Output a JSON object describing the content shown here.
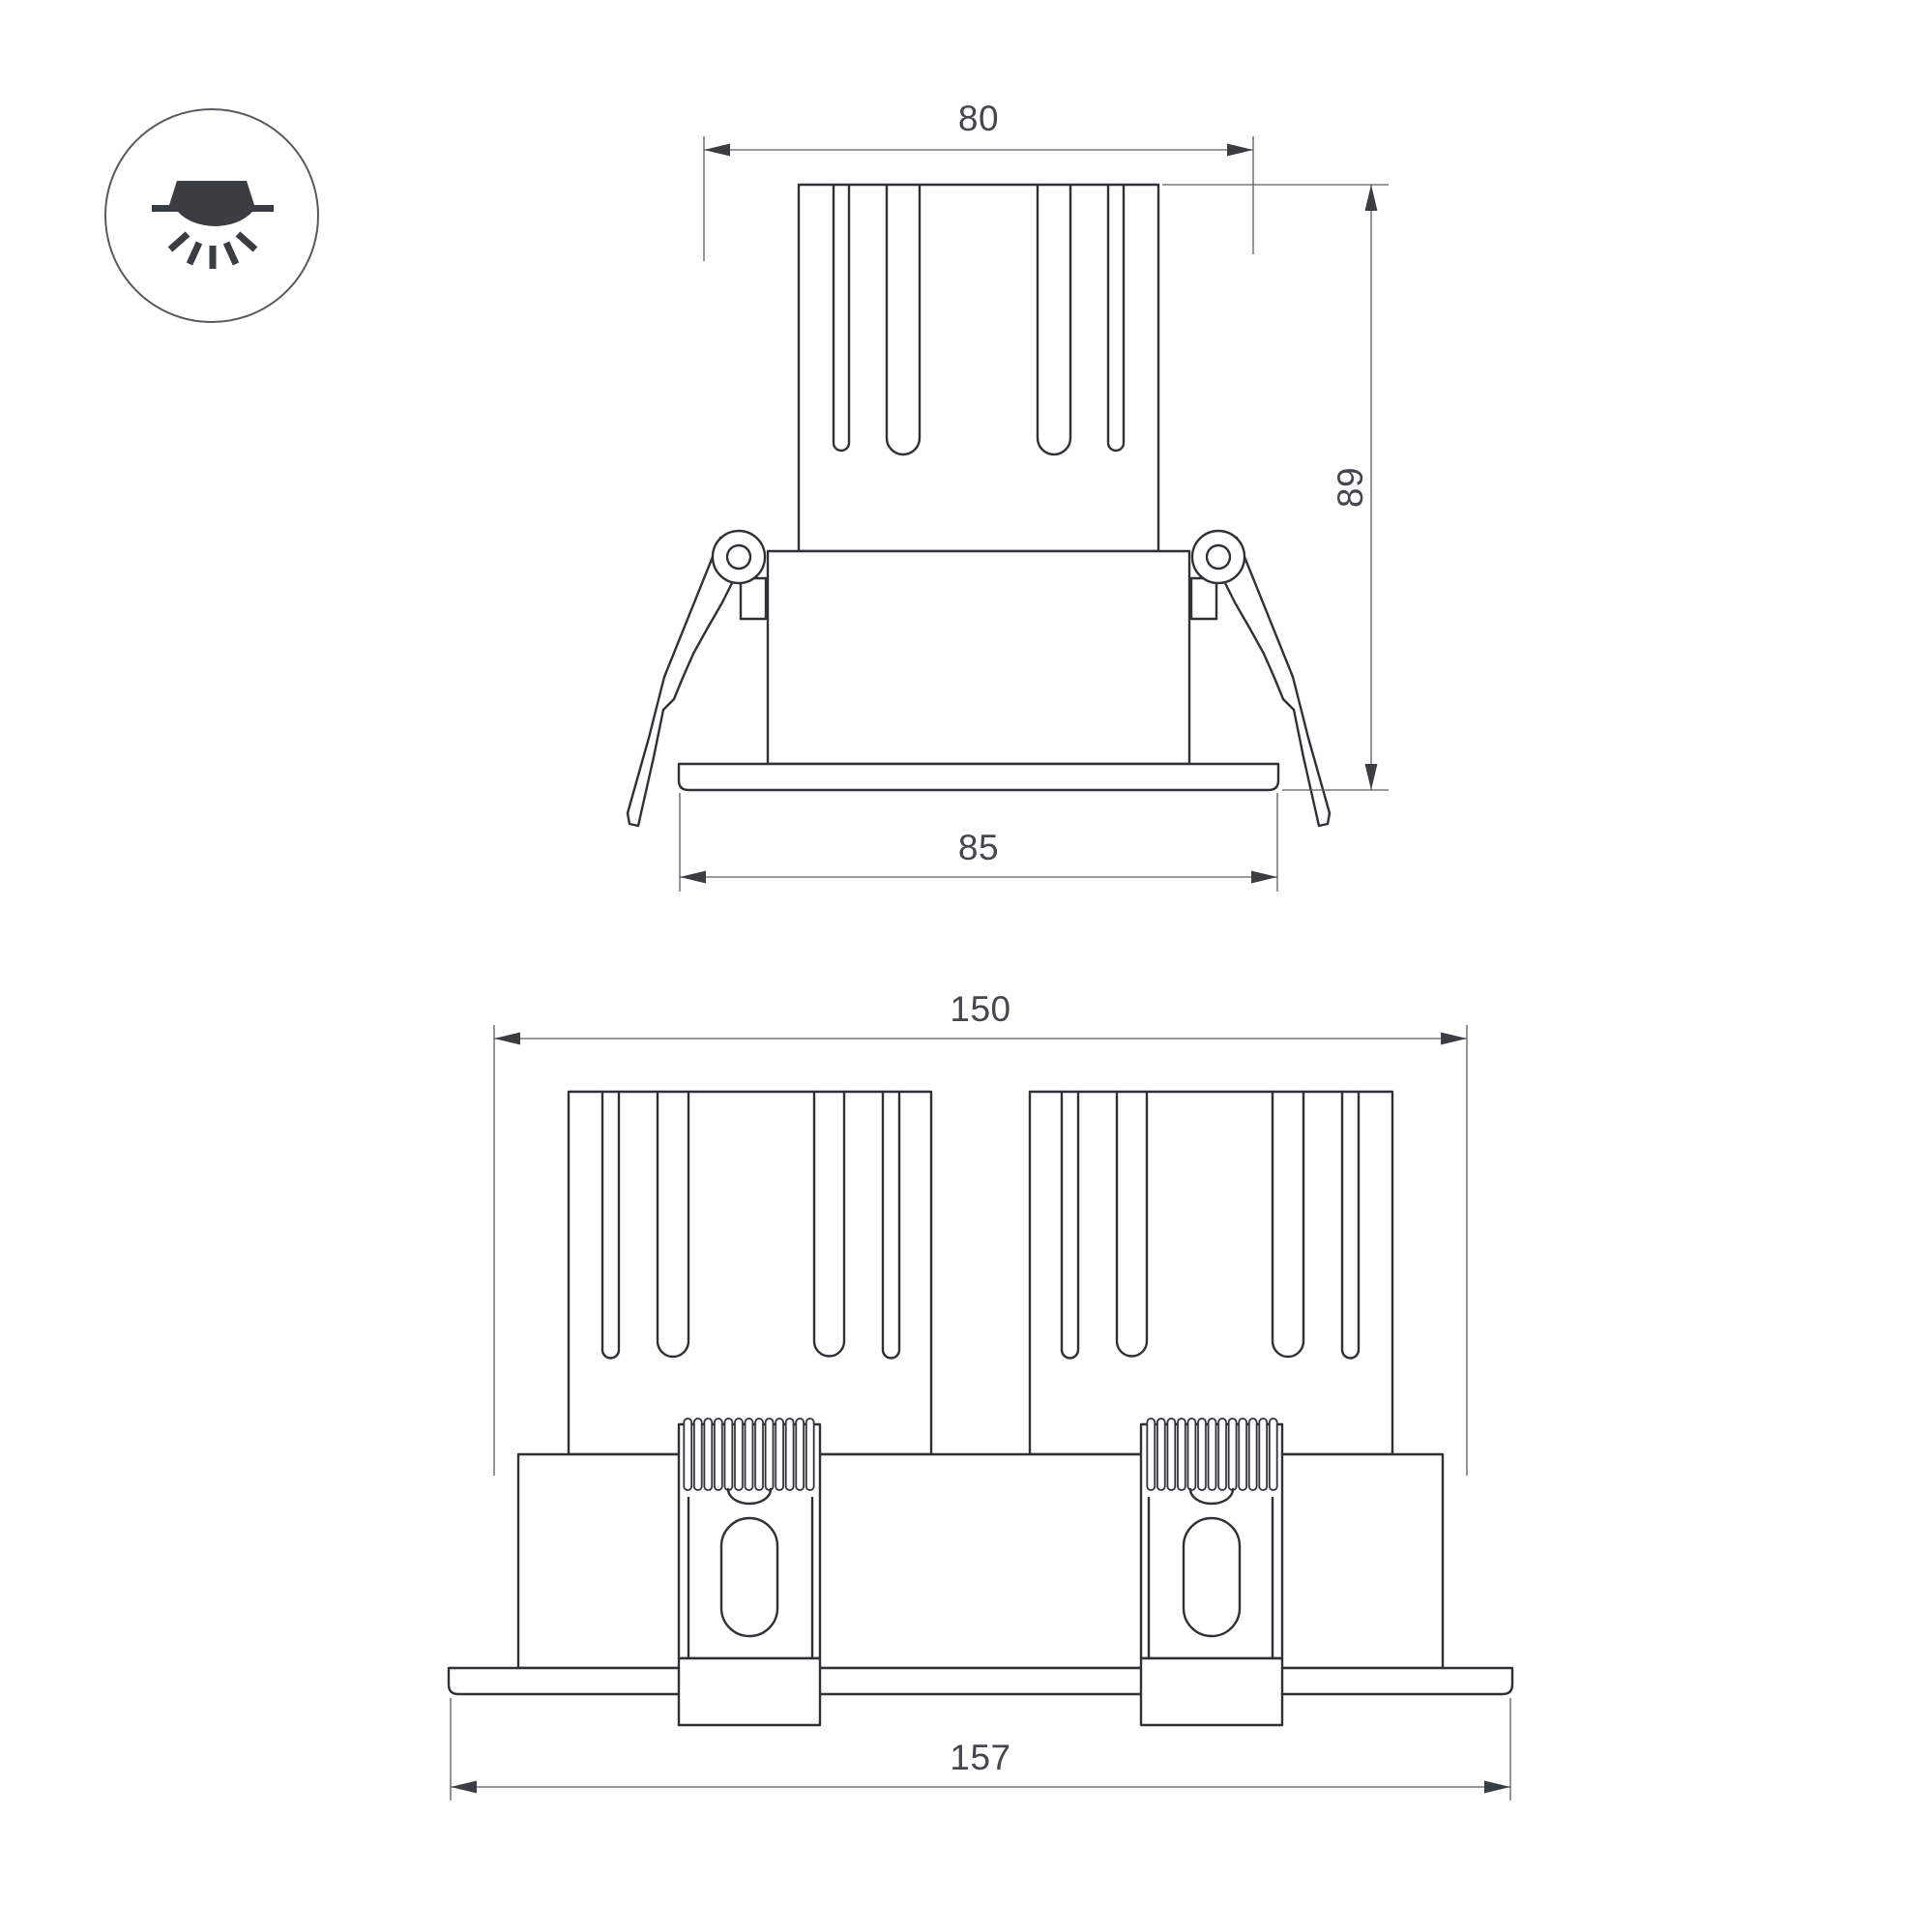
{
  "icon": {
    "name": "recessed-downlight-icon",
    "description": "circled symbol of a recessed ceiling luminaire shining downward"
  },
  "dimensions": {
    "single_cutout_width": "80",
    "single_height": "89",
    "single_flange_width": "85",
    "double_cutout_width": "150",
    "double_flange_width": "157"
  },
  "colors": {
    "outline": "#2e3236",
    "dimension_line": "#5a5e62",
    "text": "#44484c",
    "background": "#ffffff"
  }
}
